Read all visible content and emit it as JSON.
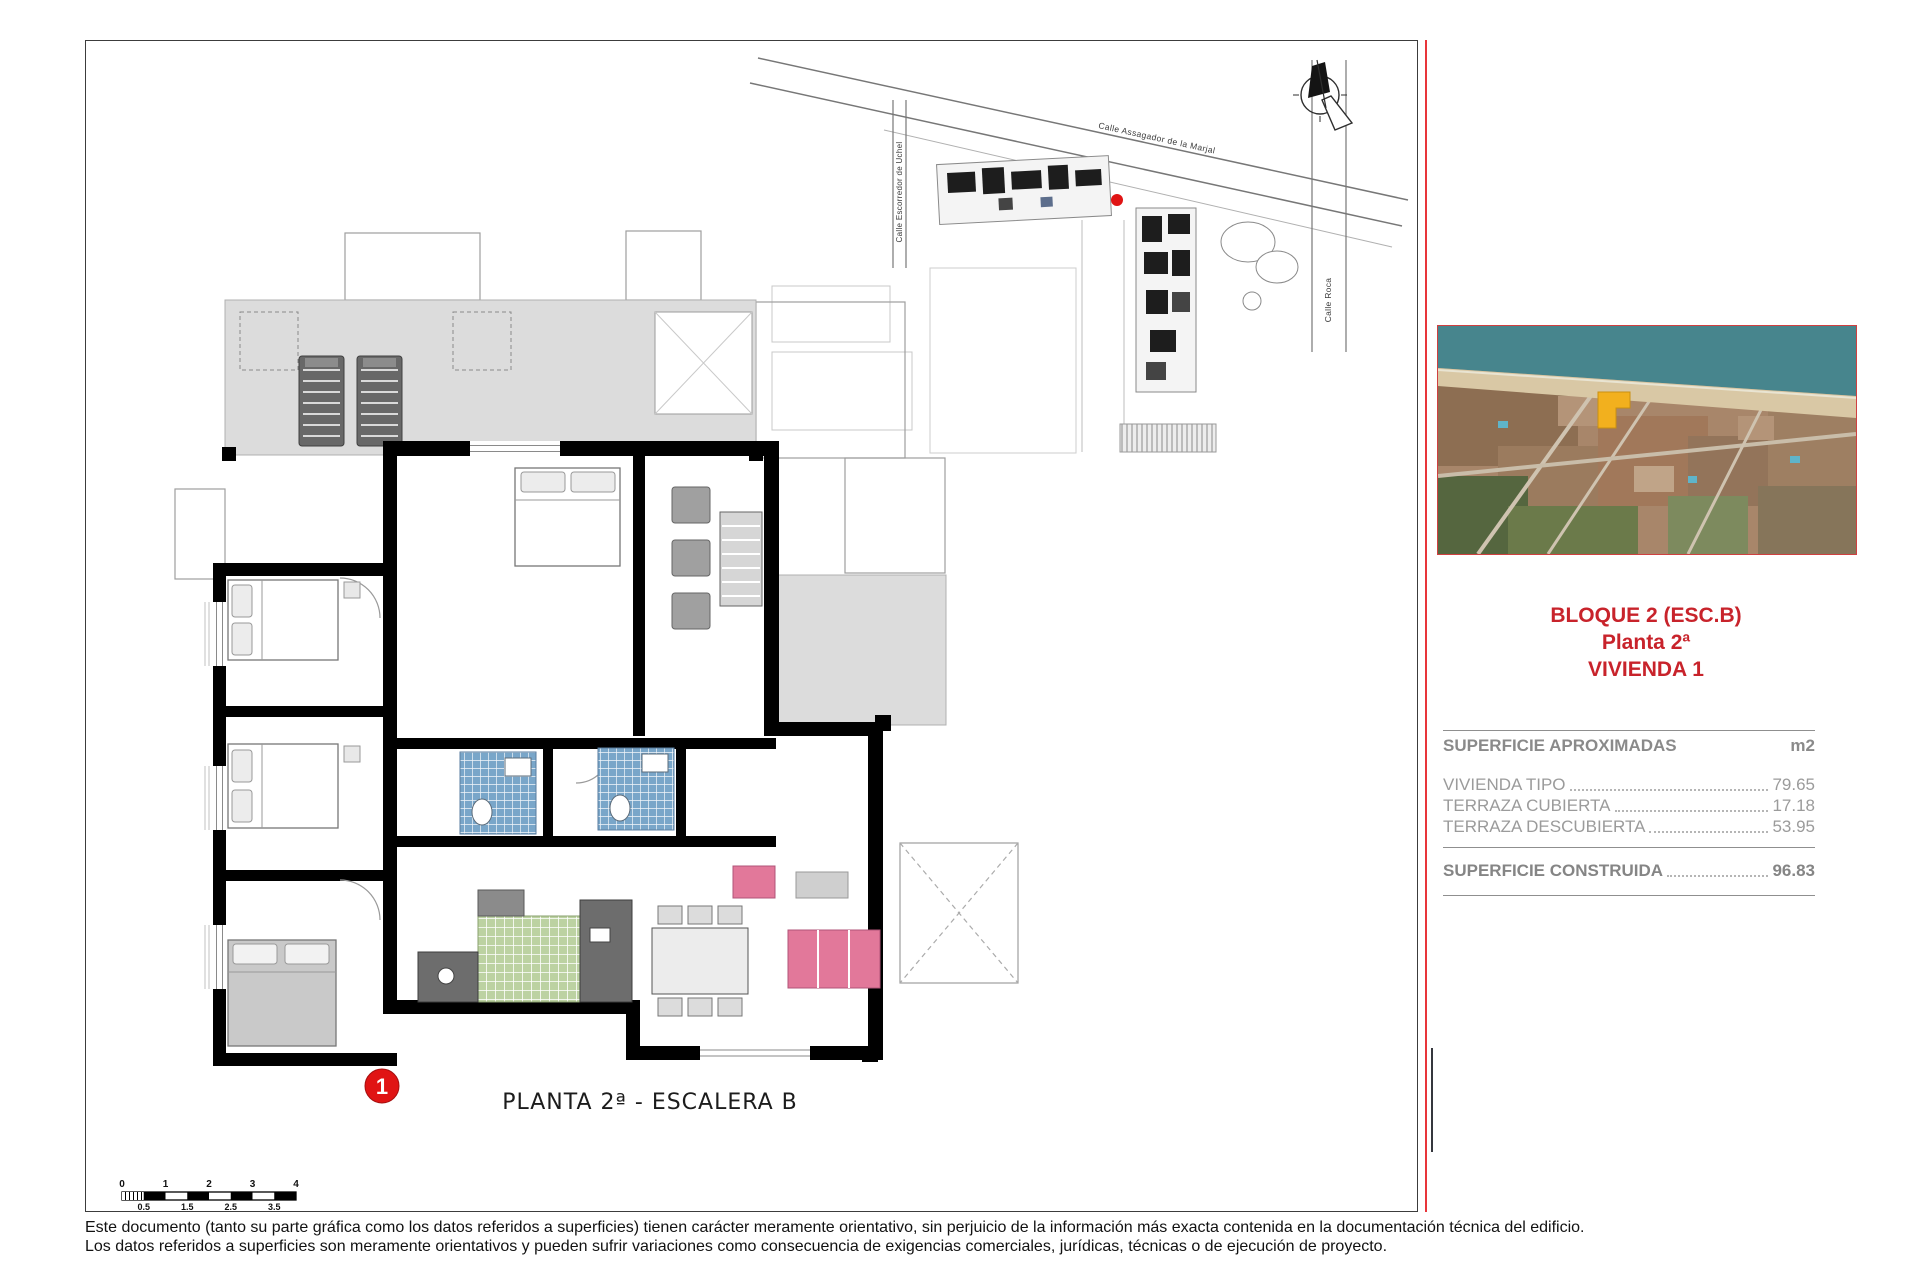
{
  "document": {
    "plan_caption": "PLANTA 2ª - ESCALERA B",
    "floor_marker": "1",
    "disclaimer_line1": "Este documento (tanto su parte gráfica como los datos referidos a superficies) tienen carácter meramente orientativo, sin perjuicio de la información más exacta contenida en la documentación técnica del edificio.",
    "disclaimer_line2": "Los datos referidos a superficies son meramente orientativos y pueden sufrir variaciones como consecuencia de exigencias comerciales, jurídicas, técnicas o de ejecución de proyecto."
  },
  "site_plan": {
    "street_top": "Calle Assagador de la Marjal",
    "street_left": "Calle Escorredor de Uchel",
    "street_right": "Calle Roca"
  },
  "info_panel": {
    "block_title": "BLOQUE 2 (ESC.B)",
    "floor_title": "Planta 2ª",
    "unit_title": "VIVIENDA 1",
    "areas": {
      "header": "SUPERFICIE APROXIMADAS",
      "unit_header": "m2",
      "rows": [
        {
          "label": "VIVIENDA TIPO",
          "value": "79.65"
        },
        {
          "label": "TERRAZA CUBIERTA",
          "value": "17.18"
        },
        {
          "label": "TERRAZA DESCUBIERTA",
          "value": "53.95"
        }
      ],
      "total_label": "SUPERFICIE CONSTRUIDA",
      "total_value": "96.83"
    }
  },
  "scale_bar": {
    "ticks_top": [
      "0",
      "1",
      "2",
      "3",
      "4"
    ],
    "ticks_bottom": [
      "0.5",
      "1.5",
      "2.5",
      "3.5"
    ]
  },
  "colors": {
    "accent_red": "#C8232B",
    "marker_red": "#E01414",
    "highlight_yellow": "#F2B01E"
  }
}
